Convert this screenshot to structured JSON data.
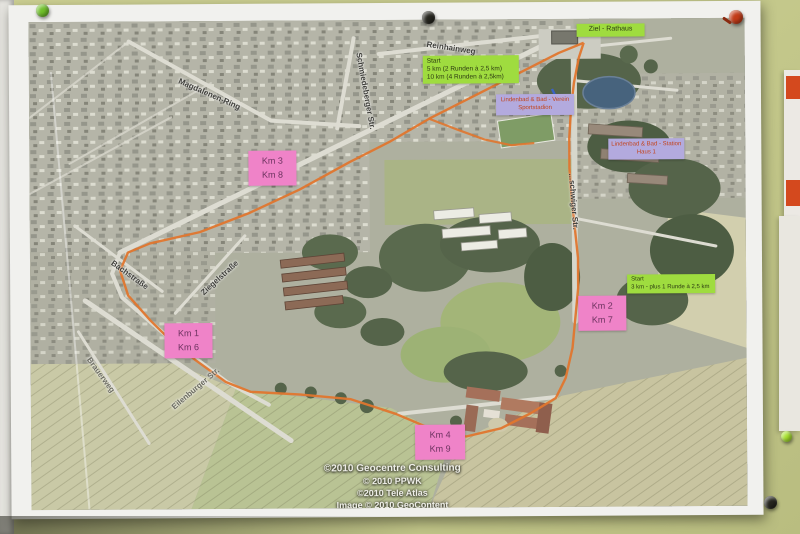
{
  "labels": {
    "start_main": {
      "title": "Start",
      "lines": [
        "5 km (2 Runden à 2,5 km)",
        "10 km (4 Runden à 2,5km)"
      ]
    },
    "ziel": "Ziel - Rathaus",
    "start_3km": {
      "title": "Start",
      "lines": [
        "3 km - plus 1 Runde à 2,5 km"
      ]
    },
    "facility_sport": {
      "lines": [
        "Lindenbad & Bad - Verein",
        "Sportstadion"
      ]
    },
    "facility_station": {
      "lines": [
        "Lindenbad & Bad - Station",
        "Haus 1"
      ]
    },
    "km": [
      {
        "top": "Km 3",
        "bottom": "Km 8"
      },
      {
        "top": "Km 1",
        "bottom": "Km 6"
      },
      {
        "top": "Km 2",
        "bottom": "Km 7"
      },
      {
        "top": "Km 4",
        "bottom": "Km 9"
      }
    ]
  },
  "streets": [
    "Reinhainweg",
    "Magdalenen-Ring",
    "Schmiedeberger Str.",
    "...schwiger Str.",
    "Bachstraße",
    "Ziegelstraße",
    "Brauerweg",
    "Eilenburger Str."
  ],
  "attribution": [
    "©2010 Geocentre Consulting",
    "© 2010 PPWK",
    "©2010 Tele Atlas",
    "Image © 2010 GeoContent"
  ],
  "colors": {
    "route_orange": "#e0762e",
    "label_pink": "#ef83c8",
    "label_green": "#9fdc3f",
    "label_purple": "#b3aade",
    "pond_blue": "#47637d",
    "board_green": "#c5c98c"
  }
}
